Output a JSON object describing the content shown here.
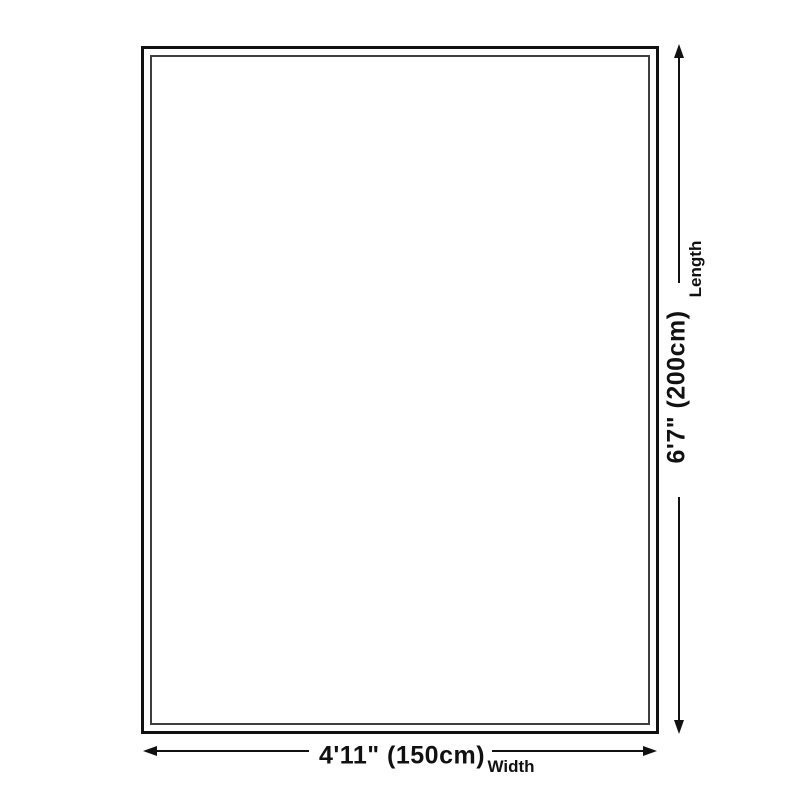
{
  "size_diagram": {
    "length": {
      "value": "6'7\" (200cm)",
      "label": "Length"
    },
    "width": {
      "value": "4'11\" (150cm)",
      "label": "Width"
    }
  },
  "colors": {
    "background": "#ffffff",
    "line": "#111111",
    "outer_border": "#111111",
    "inner_border": "#3f3f3f",
    "text": "#111111"
  }
}
